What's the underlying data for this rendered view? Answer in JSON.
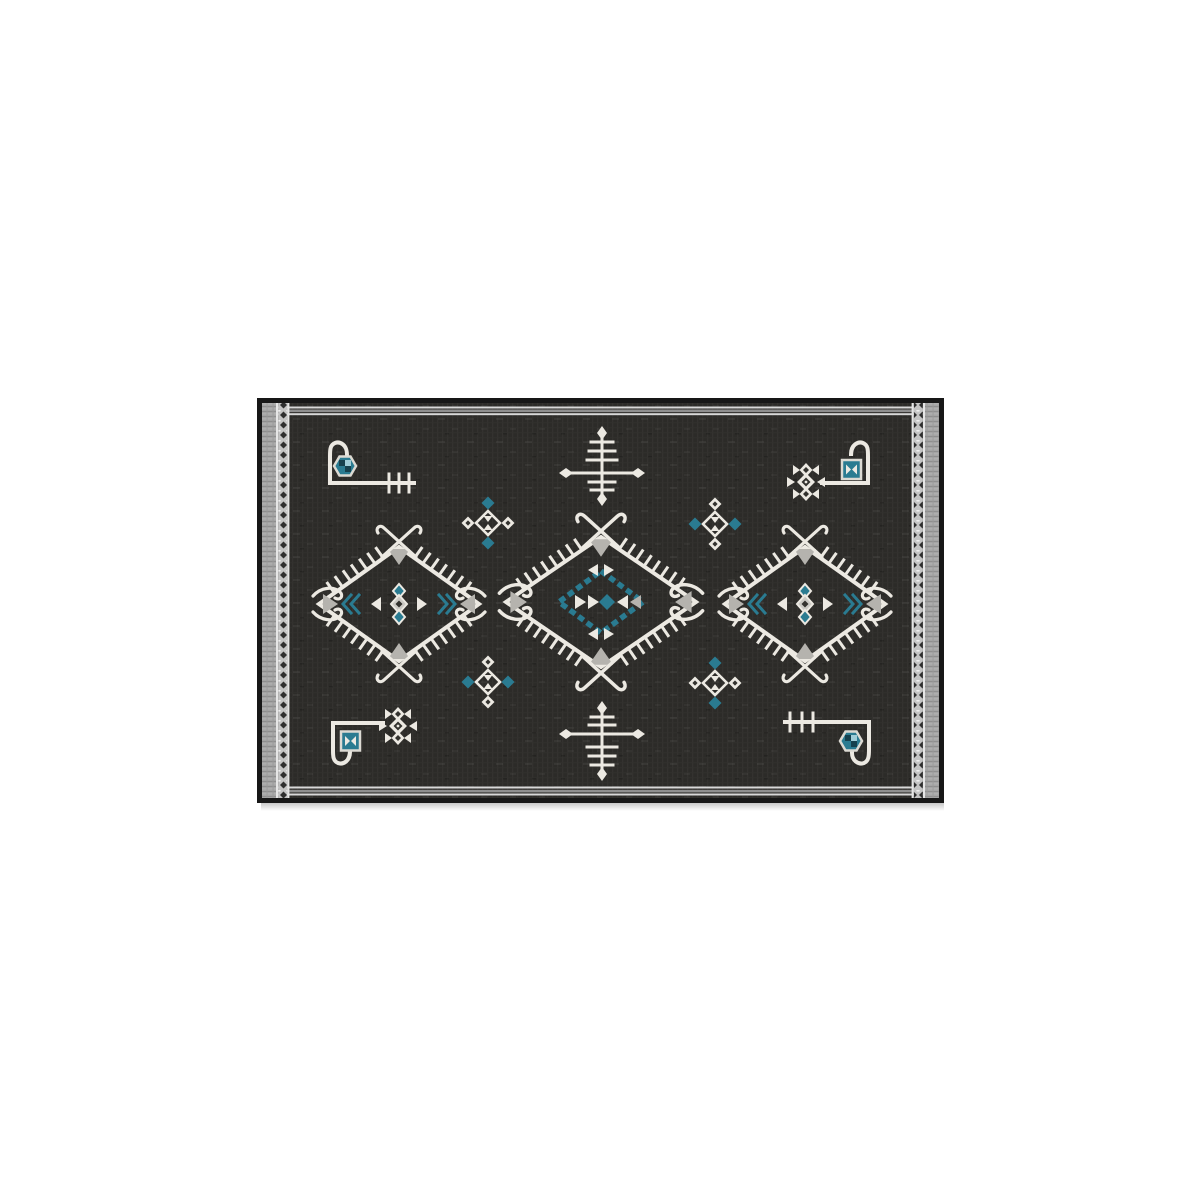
{
  "scene": {
    "type": "product-photo",
    "subject": "kilim-style dark area rug with geometric tribal motifs",
    "orientation": "landscape rug centered on white background"
  },
  "colors": {
    "background": "#ffffff",
    "frame": "#171717",
    "field": "#2c2b28",
    "motif_white": "#ece9e2",
    "motif_gray": "#b5b3ae",
    "teal": "#2a7b91",
    "teal_dark": "#16414e",
    "border_gray": "#a4a4a4",
    "border_chain_bg": "#c4c4c4",
    "border_chain_dark": "#2f2f2f",
    "border_line_light": "#d8d8d8",
    "border_line_mid": "#8f8f8f"
  },
  "motifs": {
    "medallions": [
      "side-diamond-medallion-left",
      "center-diamond-medallion",
      "side-diamond-medallion-right"
    ],
    "branches": [
      "branch-cross-top",
      "branch-cross-bottom"
    ],
    "clusters": [
      "cross-diamond-top-left",
      "cross-diamond-top-right",
      "cross-diamond-bottom-left",
      "cross-diamond-bottom-right"
    ],
    "stepped": [
      "stepped-diamond-top-right",
      "stepped-diamond-bottom-left"
    ],
    "corners": [
      "bracket-top-left-with-hexagon-and-comb",
      "bracket-top-right-with-teal-square",
      "bracket-bottom-left-with-teal-square",
      "bracket-bottom-right-with-hexagon-and-comb"
    ],
    "borders": [
      "striped-end-borders",
      "diamond-chain-side-bands"
    ]
  }
}
